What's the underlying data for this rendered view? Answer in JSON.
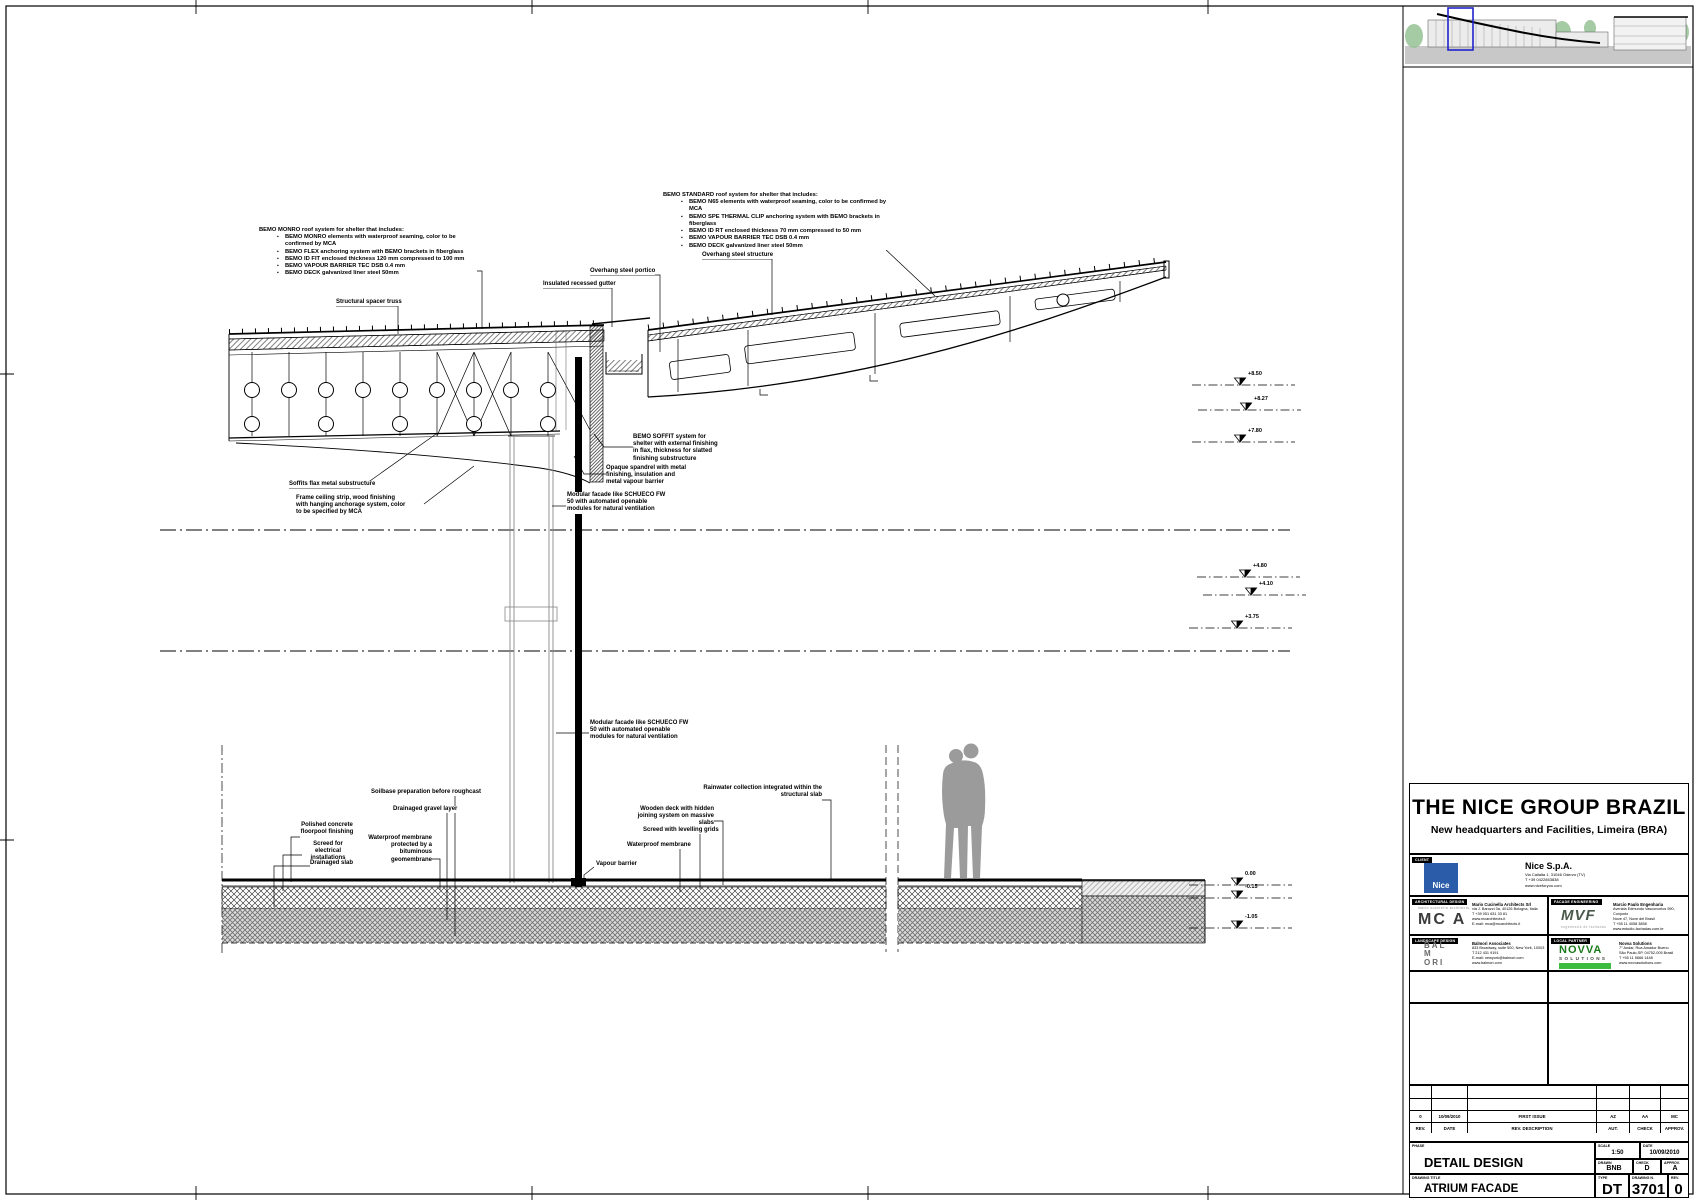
{
  "colors": {
    "keyplan_highlight": "#2222cc",
    "nice_blue": "#2a5caa",
    "novva_green": "#3dbb3d",
    "ground_gray": "#c8c8c8"
  },
  "notes": {
    "monro": {
      "title": "BEMO MONRO roof system for shelter that includes:",
      "items": [
        "BEMO MONRO elements with waterproof seaming, color to be confirmed by MCA",
        "BEMO FLEX anchoring system with BEMO brackets in fiberglass",
        "BEMO ID FIT enclosed thickness 120 mm compressed to 100 mm",
        "BEMO VAPOUR BARRIER TEC DSB 0.4 mm",
        "BEMO DECK galvanized liner steel 50mm"
      ]
    },
    "standard": {
      "title": "BEMO STANDARD roof system for shelter that includes:",
      "items": [
        "BEMO N65 elements with waterproof seaming, color to be confirmed by MCA",
        "BEMO SPE THERMAL CLIP anchoring system with BEMO brackets in fiberglass",
        "BEMO ID RT enclosed thickness 70 mm compressed to 50 mm",
        "BEMO VAPOUR BARRIER TEC DSB 0.4 mm",
        "BEMO DECK galvanized liner steel 50mm"
      ]
    }
  },
  "labels": {
    "spacer_truss": "Structural spacer truss",
    "gutter": "Insulated recessed gutter",
    "overhang_structure": "Overhang steel structure",
    "overhang_portico": "Overhang steel portico",
    "soffit_system": "BEMO SOFFIT system for shelter with external finishing in flax, thickness for slatted finishing substructure",
    "soffits_substructure": "Soffits flax metal substructure",
    "ceiling_strip": "Frame ceiling strip, wood finishing with hanging anchorage system, color to be specified by MCA",
    "spandrel": "Opaque spandrel with metal finishing, insulation and metal vapour barrier",
    "modular_facade": "Modular facade like SCHUECO FW 50 with automated openable modules for natural ventilation",
    "soil_prep": "Soilbase preparation before roughcast",
    "gravel_layer": "Drainaged gravel layer",
    "polished_concrete": "Polished concrete floorpool finishing",
    "screed_electrical": "Screed for electrical installations",
    "drainaged_slab": "Drainaged slab",
    "waterproof_protected": "Waterproof membrane protected by a bituminous geomembrane",
    "vapour_barrier": "Vapour barrier",
    "wood_deck": "Wooden deck with hidden joining system on massive slabs",
    "screed_grid": "Screed with levelling grids",
    "waterproof_membrane": "Waterproof membrane",
    "rainwater": "Rainwater collection integrated within the structural slab"
  },
  "elevations": [
    "+8.50",
    "+8.27",
    "+7.80",
    "+4.80",
    "+4.10",
    "+3.75",
    "0.00",
    "-0.15",
    "-1.05"
  ],
  "title_block": {
    "project_title": "THE NICE GROUP BRAZIL",
    "project_subtitle": "New headquarters and Facilities, Limeira (BRA)",
    "client": {
      "tag": "CLIENT",
      "logo_text": "Nice",
      "name": "Nice S.p.A.",
      "lines": [
        "Via Callalta 1, 31046 Oderzo (TV)",
        "T +39 0422853838",
        "www.niceforyou.com"
      ]
    },
    "consultants": [
      {
        "tag": "ARCHITECTURAL DESIGN",
        "logo": "MC A",
        "logo_caption": "mario cucinella architects",
        "lines": [
          "Mario Cucinella Architects Srl",
          "via J. Barozzi 3a, 40126 Bologna, Italia",
          "T +39 051 631 33 81",
          "www.mcarchitects.it",
          "E-mail: mca@mcarchitects.it"
        ]
      },
      {
        "tag": "FACADE ENGINEERING",
        "logo": "MVF",
        "logo_caption": "engenharia de fachadas",
        "lines": [
          "Marcio Paulo Engenharia",
          "Avenida Edmundo Vasconcelos 590, Conjunto",
          "Nove 47, Nove del Brasil",
          "T +55 11 4058 3858",
          "www.estudio-fachadas.com.br"
        ]
      },
      {
        "tag": "LANDSCAPE DESIGN",
        "logo": "BAL\nM\nORI",
        "logo_caption": "",
        "lines": [
          "Balmori Associates",
          "833 Broadway, suite 500, New York, 10003",
          "T 212 431 9191",
          "E-mail: newyork@balmori.com",
          "www.balmori.com"
        ]
      },
      {
        "tag": "LOCAL PARTNER",
        "logo": "NOVVA",
        "logo_caption": "SOLUTIONS",
        "lines": [
          "Novva Solutions",
          "7° Andar, Rua Amador Bueno",
          "São Paulo-SP, 04752-005 Brasil",
          "T +55 11 5666 1448",
          "www.novvasolutions.com"
        ]
      }
    ],
    "revision_table": {
      "headers": [
        "REV.",
        "DATE",
        "REV. DESCRIPTION",
        "AUT.",
        "CHECK",
        "APPROV."
      ],
      "rows": [
        [
          "0",
          "10/09/2010",
          "FIRST ISSUE",
          "AZ",
          "AA",
          "MC"
        ]
      ]
    },
    "phase": {
      "label": "PHASE",
      "value": "DETAIL DESIGN"
    },
    "scale": {
      "label": "SCALE",
      "value": "1:50"
    },
    "date": {
      "label": "DATE",
      "value": "10/09/2010"
    },
    "drawn": {
      "label": "DRAWN",
      "value": "BNB"
    },
    "check": {
      "label": "CHECK",
      "value": "D"
    },
    "approv": {
      "label": "APPROV.",
      "value": "A"
    },
    "drawing_title": {
      "label": "DRAWING TITLE",
      "value": "ATRIUM FACADE"
    },
    "type": {
      "label": "TYPE",
      "value": "DT"
    },
    "number": {
      "label": "DRAWING N.",
      "value": "3701"
    },
    "rev": {
      "label": "REV.",
      "value": "0"
    }
  }
}
